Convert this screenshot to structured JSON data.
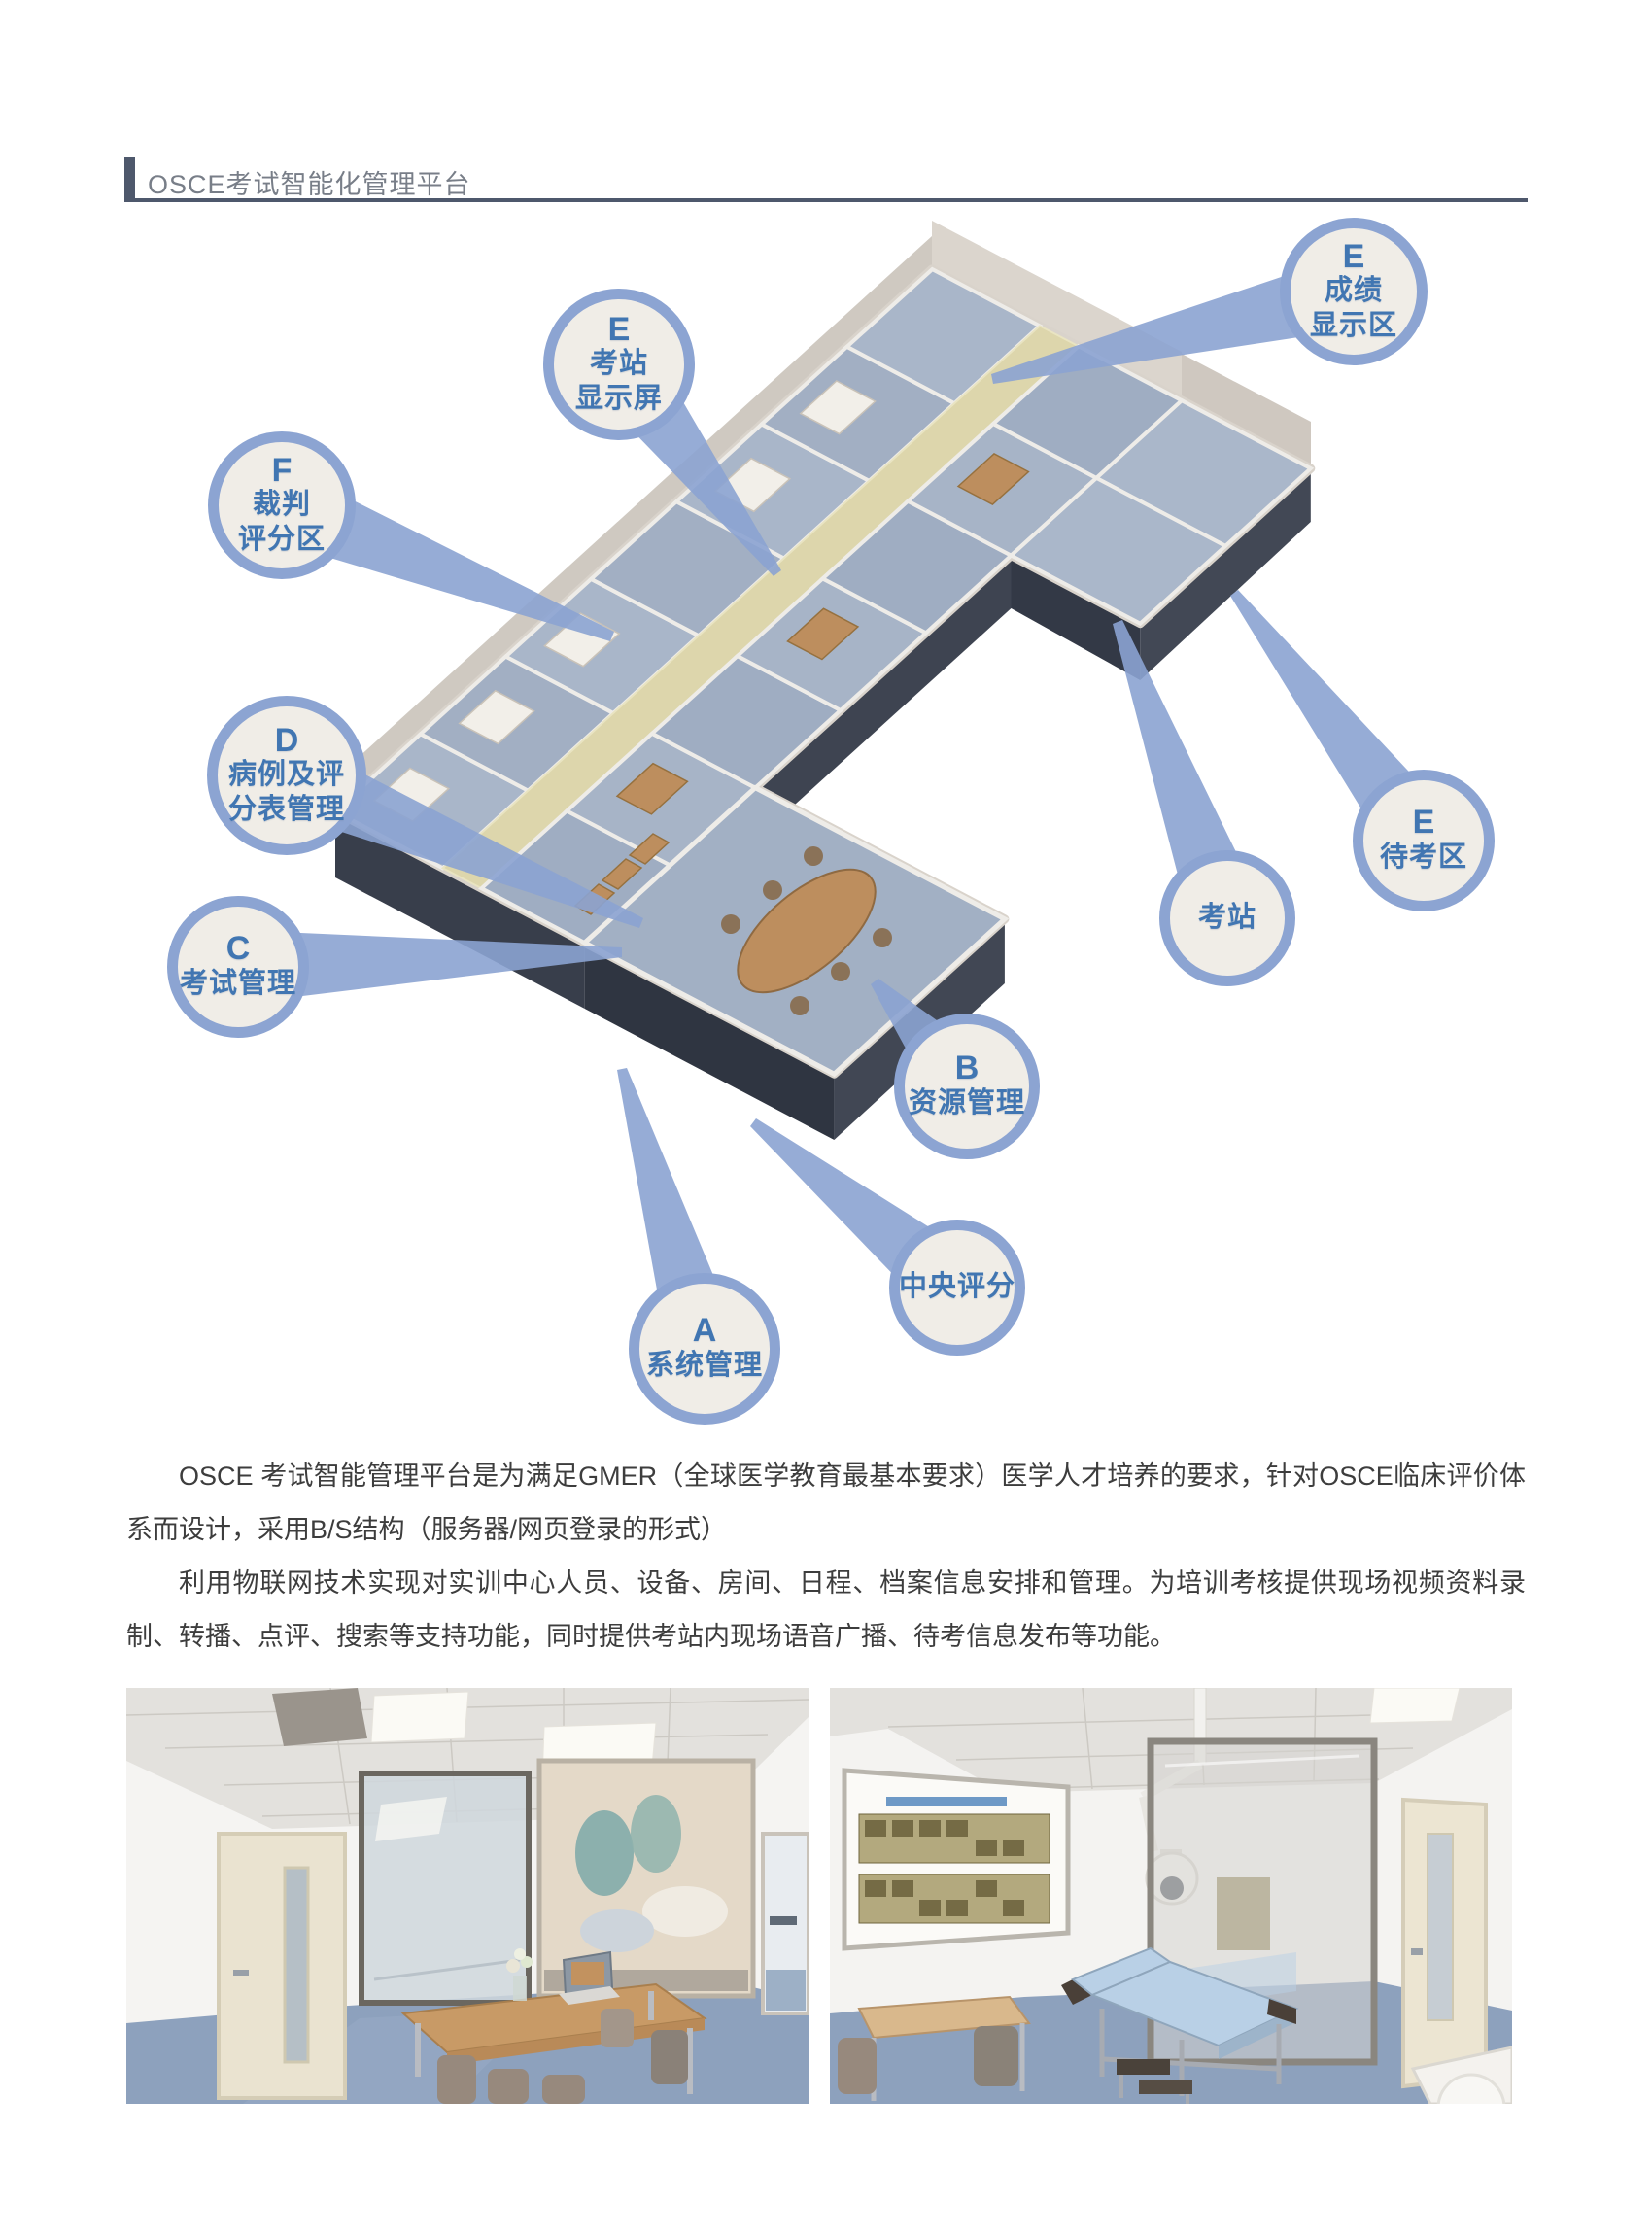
{
  "header": {
    "title": "OSCE考试智能化管理平台"
  },
  "diagram": {
    "callouts": [
      {
        "id": "e-score-display",
        "letter": "E",
        "line1": "成绩",
        "line2": "显示区"
      },
      {
        "id": "e-station-screen",
        "letter": "E",
        "line1": "考站",
        "line2": "显示屏"
      },
      {
        "id": "f-judge-scoring",
        "letter": "F",
        "line1": "裁判",
        "line2": "评分区"
      },
      {
        "id": "d-case-score-mgmt",
        "letter": "D",
        "line1": "病例及评",
        "line2": "分表管理"
      },
      {
        "id": "c-exam-mgmt",
        "letter": "C",
        "line1": "考试管理"
      },
      {
        "id": "e-waiting-area",
        "letter": "E",
        "line1": "待考区"
      },
      {
        "id": "exam-station",
        "line1": "考站"
      },
      {
        "id": "b-resource-mgmt",
        "letter": "B",
        "line1": "资源管理"
      },
      {
        "id": "central-scoring",
        "line1": "中央评分"
      },
      {
        "id": "a-system-mgmt",
        "letter": "A",
        "line1": "系统管理"
      }
    ]
  },
  "body": {
    "paragraph1": "OSCE 考试智能管理平台是为满足GMER（全球医学教育最基本要求）医学人才培养的要求，针对OSCE临床评价体系而设计，采用B/S结构（服务器/网页登录的形式）",
    "paragraph2": "利用物联网技术实现对实训中心人员、设备、房间、日程、档案信息安排和管理。为培训考核提供现场视频资料录制、转播、点评、搜索等支持功能，同时提供考站内现场语音广播、待考信息发布等功能。"
  },
  "colors": {
    "accent_blue": "#8ca4d2",
    "bubble_fill": "#f0ede7",
    "bubble_text": "#4176b2",
    "header_rule": "#4e586c",
    "corridor": "#ddd6ac",
    "room_floor": "#a7b4c7",
    "plinth_dark": "#383e4b"
  }
}
